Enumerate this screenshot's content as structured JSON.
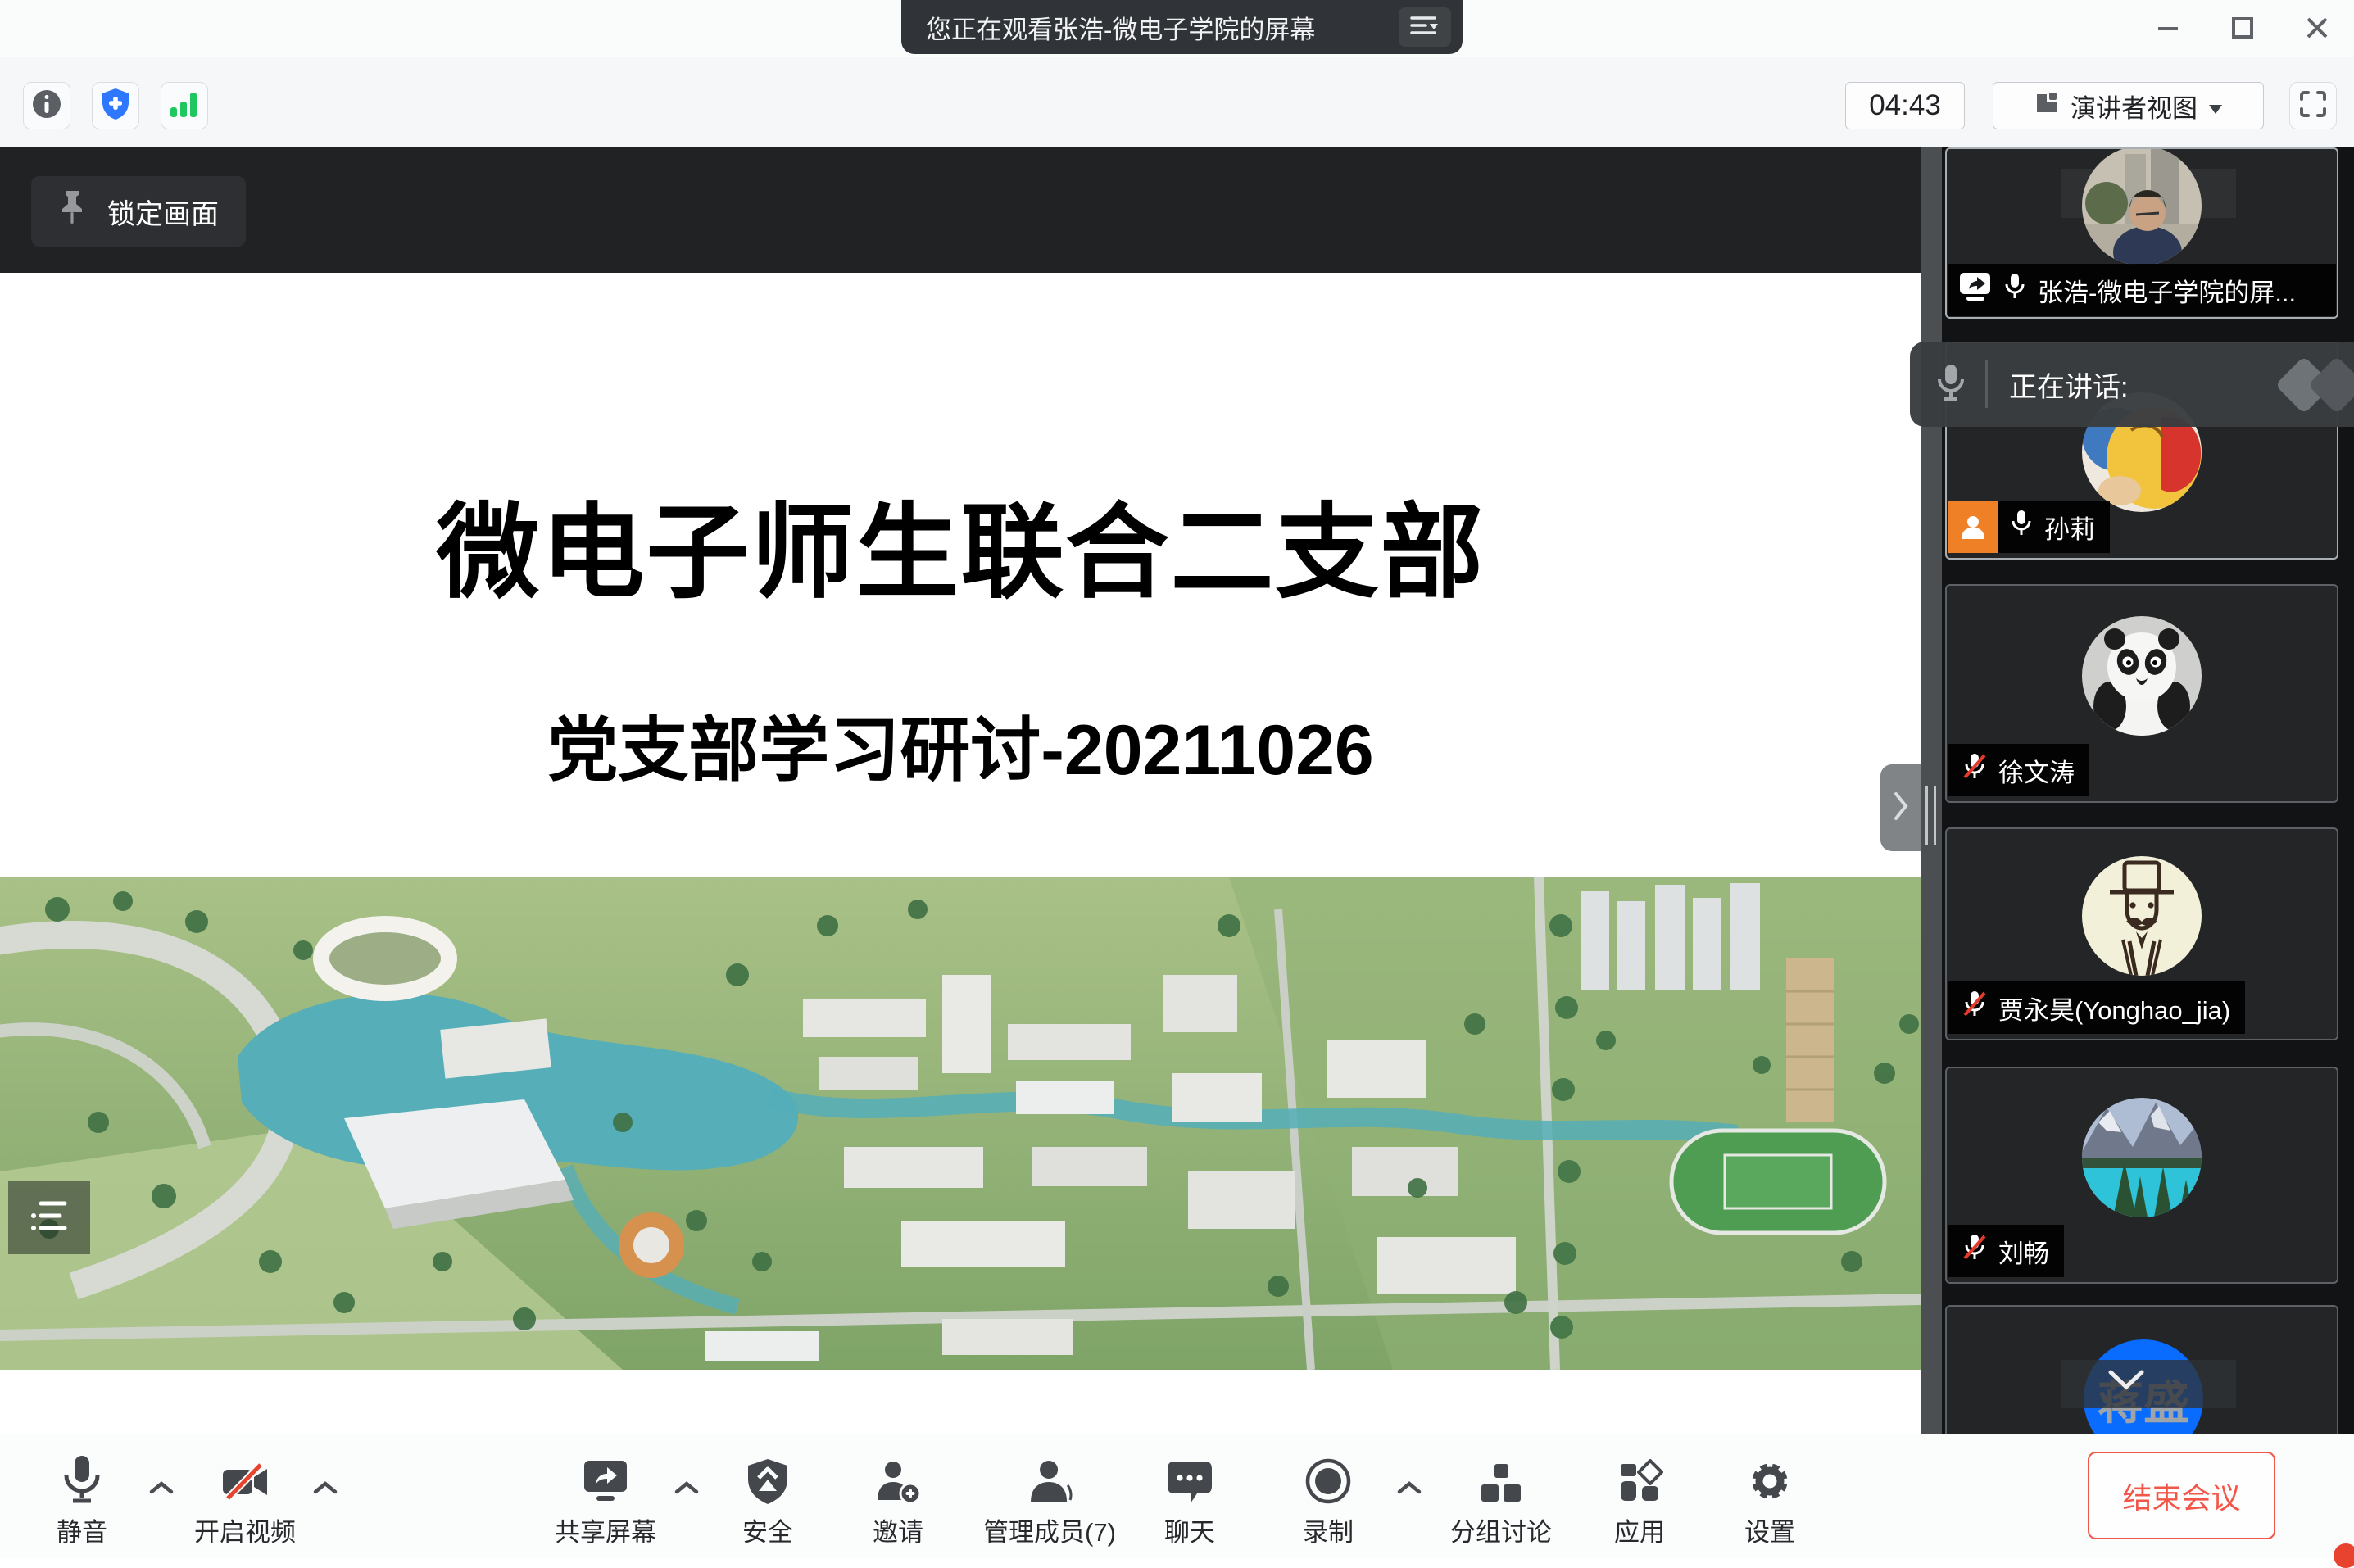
{
  "window": {
    "title": "您正在观看张浩-微电子学院的屏幕"
  },
  "topbar": {
    "timer": "04:43",
    "view_mode": "演讲者视图"
  },
  "stage": {
    "lock_label": "锁定画面"
  },
  "slide": {
    "title": "微电子师生联合二支部",
    "subtitle": "党支部学习研讨-20211026"
  },
  "speaking": {
    "label": "正在讲话:"
  },
  "participants": [
    {
      "name": "张浩-微电子学院的屏...",
      "muted": false,
      "sharing": true
    },
    {
      "name": "孙莉",
      "muted": false,
      "badge": "host"
    },
    {
      "name": "徐文涛",
      "muted": true
    },
    {
      "name": "贾永昊(Yonghao_jia)",
      "muted": true
    },
    {
      "name": "刘畅",
      "muted": true
    },
    {
      "name": "蒋盛",
      "avatar_text": "蒋盛"
    }
  ],
  "toolbar": {
    "mute": "静音",
    "start_video": "开启视频",
    "share_screen": "共享屏幕",
    "security": "安全",
    "invite": "邀请",
    "manage_members": "管理成员(7)",
    "chat": "聊天",
    "record": "录制",
    "breakout": "分组讨论",
    "apps": "应用",
    "settings": "设置",
    "end_meeting": "结束会议"
  },
  "colors": {
    "accent_blue": "#2e77ff",
    "signal_green": "#1fc85f",
    "danger_red": "#e8432e",
    "end_red": "#f25648",
    "host_badge_orange": "#f08025",
    "active_border": "#a9aeb3"
  }
}
